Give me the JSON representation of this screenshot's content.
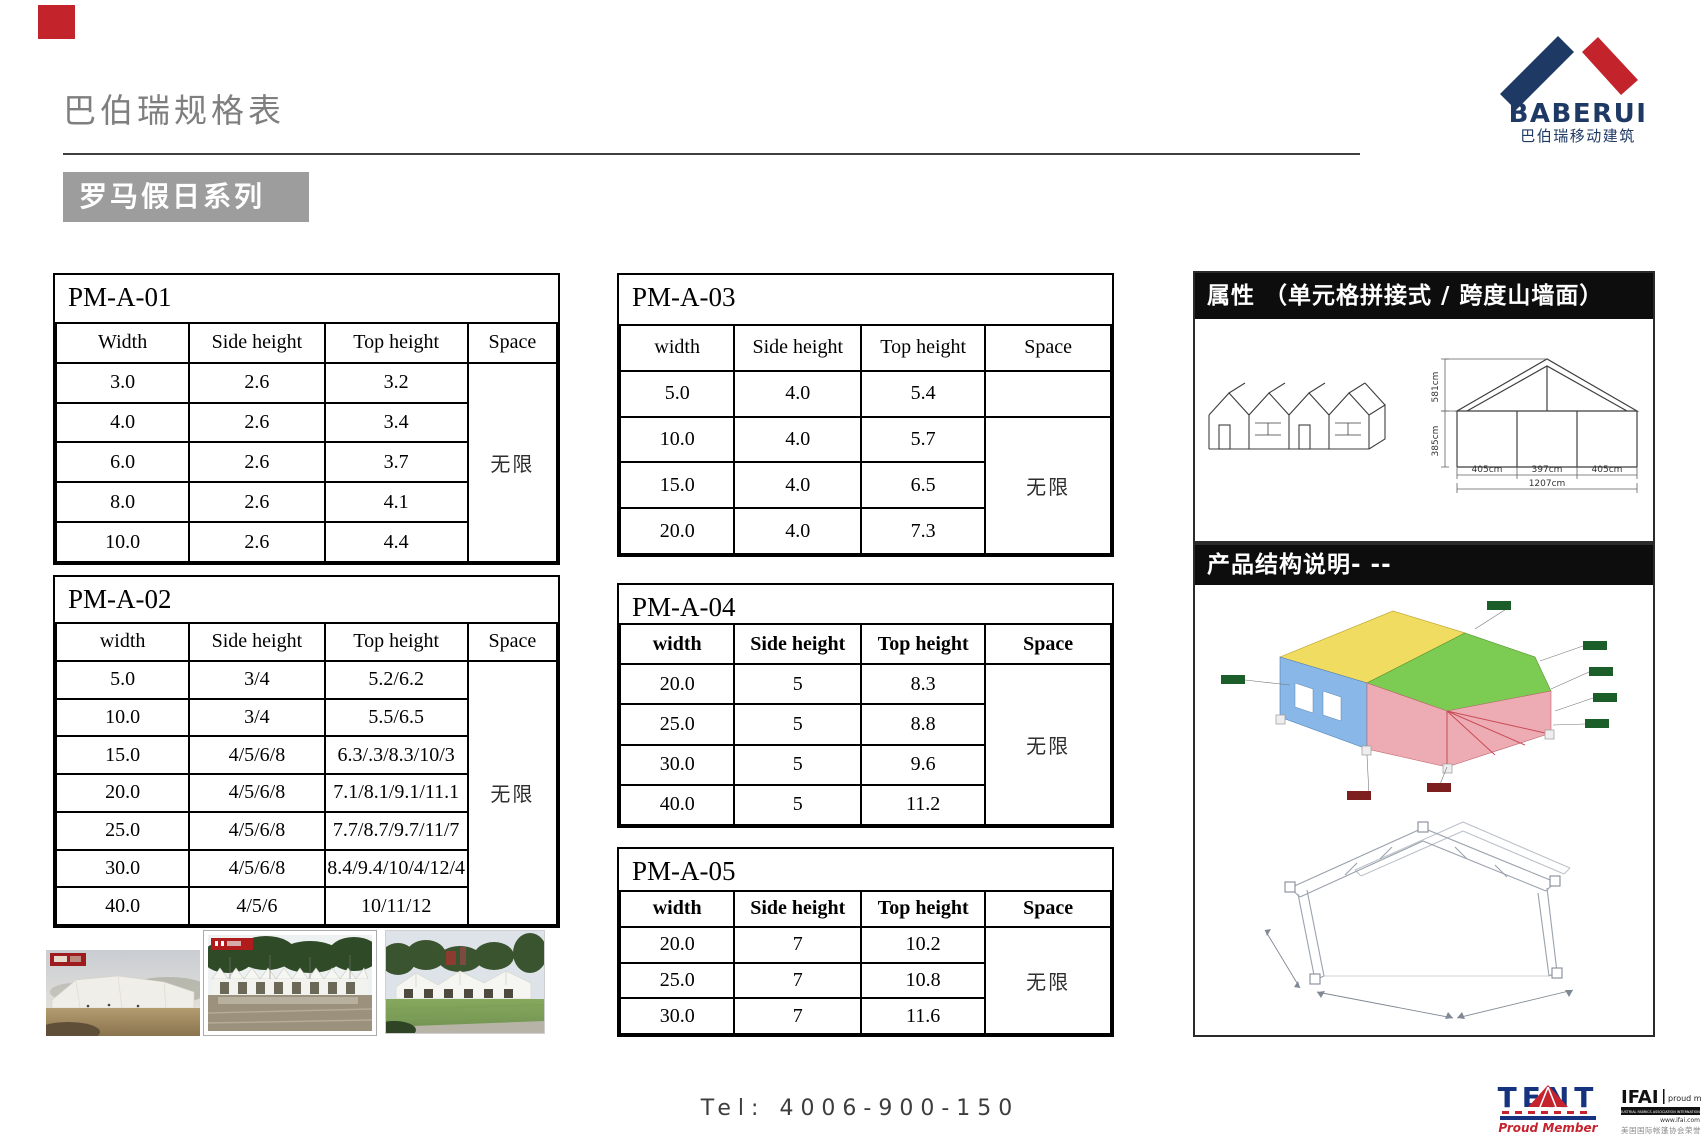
{
  "page": {
    "title": "巴伯瑞规格表",
    "series_badge": "罗马假日系列"
  },
  "brand": {
    "name": "BABERUI",
    "name_cn": "巴伯瑞移动建筑"
  },
  "tables": [
    {
      "id": "PM-A-01",
      "headers": [
        "Width",
        "Side height",
        "Top height",
        "Space"
      ],
      "rows": [
        [
          "3.0",
          "2.6",
          "3.2"
        ],
        [
          "4.0",
          "2.6",
          "3.4"
        ],
        [
          "6.0",
          "2.6",
          "3.7"
        ],
        [
          "8.0",
          "2.6",
          "4.1"
        ],
        [
          "10.0",
          "2.6",
          "4.4"
        ]
      ],
      "space": "无限",
      "space_start": 0,
      "bold_headers": false
    },
    {
      "id": "PM-A-02",
      "headers": [
        "width",
        "Side height",
        "Top height",
        "Space"
      ],
      "rows": [
        [
          "5.0",
          "3/4",
          "5.2/6.2"
        ],
        [
          "10.0",
          "3/4",
          "5.5/6.5"
        ],
        [
          "15.0",
          "4/5/6/8",
          "6.3/.3/8.3/10/3"
        ],
        [
          "20.0",
          "4/5/6/8",
          "7.1/8.1/9.1/11.1"
        ],
        [
          "25.0",
          "4/5/6/8",
          "7.7/8.7/9.7/11/7"
        ],
        [
          "30.0",
          "4/5/6/8",
          "8.4/9.4/10/4/12/4"
        ],
        [
          "40.0",
          "4/5/6",
          "10/11/12"
        ]
      ],
      "space": "无限",
      "space_start": 0,
      "bold_headers": false
    },
    {
      "id": "PM-A-03",
      "headers": [
        "width",
        "Side height",
        "Top height",
        "Space"
      ],
      "rows": [
        [
          "5.0",
          "4.0",
          "5.4"
        ],
        [
          "10.0",
          "4.0",
          "5.7"
        ],
        [
          "15.0",
          "4.0",
          "6.5"
        ],
        [
          "20.0",
          "4.0",
          "7.3"
        ]
      ],
      "space": "无限",
      "space_start": 1,
      "bold_headers": false
    },
    {
      "id": "PM-A-04",
      "headers": [
        "width",
        "Side height",
        "Top height",
        "Space"
      ],
      "rows": [
        [
          "20.0",
          "5",
          "8.3"
        ],
        [
          "25.0",
          "5",
          "8.8"
        ],
        [
          "30.0",
          "5",
          "9.6"
        ],
        [
          "40.0",
          "5",
          "11.2"
        ]
      ],
      "space": "无限",
      "space_start": 0,
      "bold_headers": true
    },
    {
      "id": "PM-A-05",
      "headers": [
        "width",
        "Side height",
        "Top height",
        "Space"
      ],
      "rows": [
        [
          "20.0",
          "7",
          "10.2"
        ],
        [
          "25.0",
          "7",
          "10.8"
        ],
        [
          "30.0",
          "7",
          "11.6"
        ]
      ],
      "space": "无限",
      "space_start": 0,
      "bold_headers": true
    }
  ],
  "panels": {
    "attributes": {
      "title": "属性 （单元格拼接式 / 跨度山墙面）",
      "dims": {
        "ridge_height": "581cm",
        "eave_height": "385cm",
        "bay1": "405cm",
        "bay2": "397cm",
        "bay3": "405cm",
        "total_span": "1207cm"
      }
    },
    "structure": {
      "title": "产品结构说明- --"
    }
  },
  "footer": {
    "tel": "Tel: 4006-900-150",
    "tent_logo": {
      "name": "TENT",
      "subtitle": "Proud Member"
    },
    "ifai_logo": {
      "name": "IFAI",
      "tagline": "proud member",
      "bar": "INDUSTRIAL FABRICS ASSOCIATION INTERNATIONAL",
      "site": "www.ifai.com",
      "cn": "美国国际帐篷协会荣誉会员"
    }
  },
  "colors": {
    "brand_navy": "#1e3a64",
    "brand_red": "#c3242c",
    "badge_gray": "#9d9d9d",
    "header_black": "#0d0d0d"
  }
}
